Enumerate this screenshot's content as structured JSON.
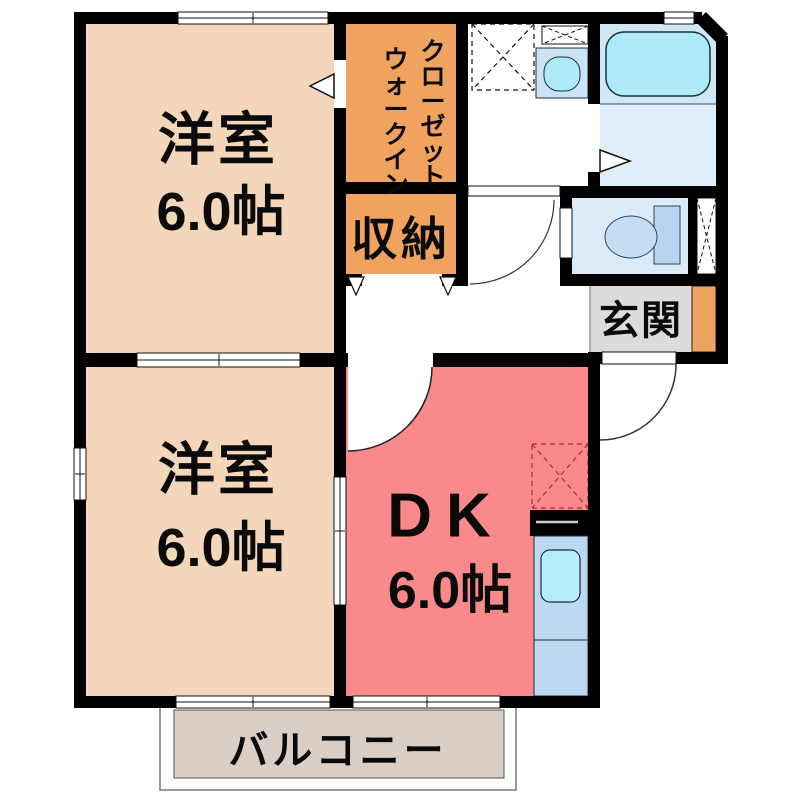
{
  "plan": {
    "rooms": {
      "bedroom_top": {
        "label": "洋室",
        "size": "6.0帖"
      },
      "bedroom_bottom": {
        "label": "洋室",
        "size": "6.0帖"
      },
      "dining_kitchen": {
        "label": "DK",
        "size": "6.0帖"
      },
      "walk_in_closet": {
        "column_right": "クローゼット",
        "column_left": "ウォークイン"
      },
      "storage": {
        "label": "収納"
      },
      "entrance": {
        "label": "玄関"
      },
      "balcony": {
        "label": "バルコニー"
      }
    },
    "colors": {
      "wall": "#000000",
      "bedroom_fill": "#f4d6ba",
      "closet_fill": "#f0a35e",
      "dk_fill": "#f9898a",
      "entrance_fill": "#dcdcdc",
      "shoe_cabinet_fill": "#f0a35e",
      "balcony_fill": "#d9cfc6",
      "bath_upper": "#cfe9f4",
      "bath_lower": "#e0f0fb",
      "bathtub": "#aeeaf8",
      "toilet_room": "#dcebf8",
      "toilet_tank": "#b9d4ef",
      "toilet_bowl": "#c6dcf3",
      "washbasin_unit": "#cbe4f4",
      "washbasin_bowl": "#aeeaf8",
      "kitchen_unit": "#bdd9f2",
      "kitchen_sink": "#b5eef8",
      "fridge_dash": "#b93636"
    }
  }
}
